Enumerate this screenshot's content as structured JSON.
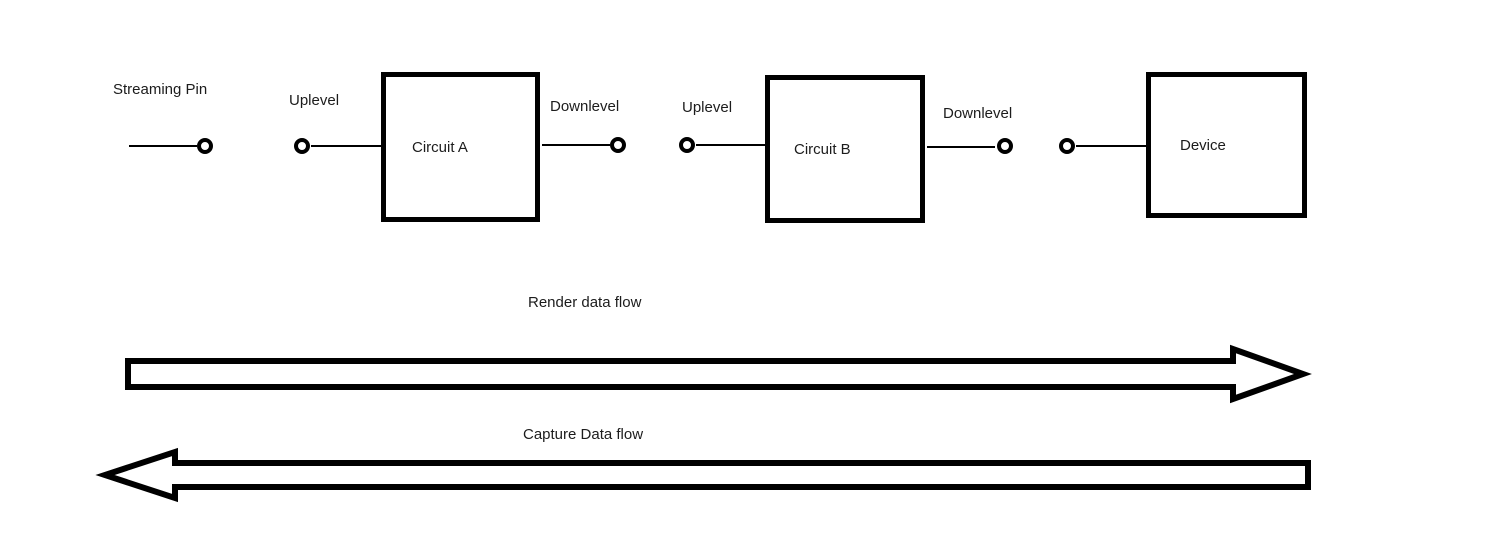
{
  "palette": {
    "background": "#ffffff",
    "ink": "#000000",
    "text": "#1c1c1c"
  },
  "pins": {
    "streaming_pin": {
      "label": "Streaming Pin"
    },
    "uplevel_a": {
      "label": "Uplevel"
    },
    "downlevel_a": {
      "label": "Downlevel"
    },
    "uplevel_b": {
      "label": "Uplevel"
    },
    "downlevel_b": {
      "label": "Downlevel"
    }
  },
  "blocks": {
    "circuit_a": {
      "label": "Circuit A"
    },
    "circuit_b": {
      "label": "Circuit B"
    },
    "device": {
      "label": "Device"
    }
  },
  "flows": {
    "render": {
      "label": "Render data flow",
      "direction": "right"
    },
    "capture": {
      "label": "Capture Data flow",
      "direction": "left"
    }
  }
}
